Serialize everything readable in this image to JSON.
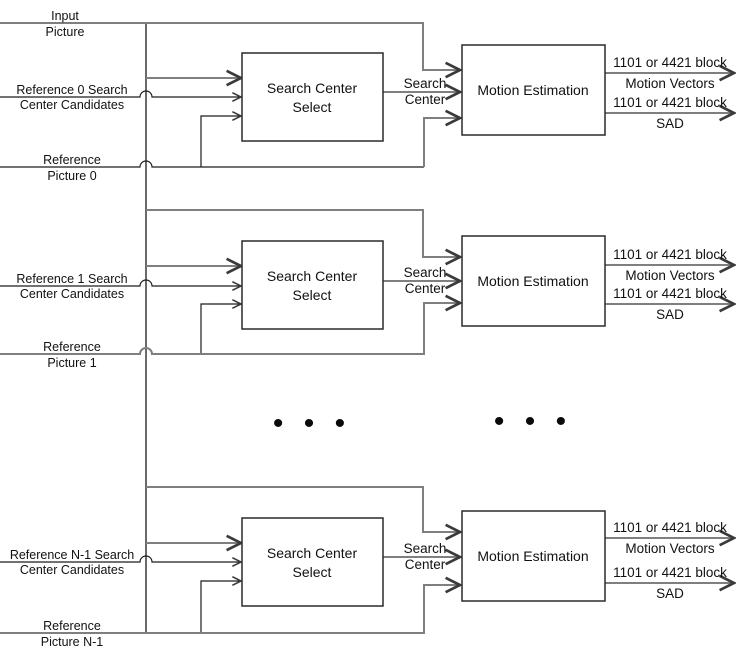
{
  "colors": {
    "line_gray": "#7f7f7f",
    "line_dark": "#1c1c1c",
    "text": "#111111",
    "background": "#ffffff"
  },
  "input_picture": {
    "top": "Input",
    "bottom": "Picture"
  },
  "ellipsis": {
    "glyph": "• • •"
  },
  "rows": [
    {
      "candidates_top": "Reference 0 Search",
      "candidates_bottom": "Center Candidates",
      "ref_top": "Reference",
      "ref_bottom": "Picture 0",
      "scs_line1": "Search Center",
      "scs_line2": "Select",
      "me_label": "Motion Estimation",
      "sc_top": "Search",
      "sc_bottom": "Center",
      "out1_top": "1101 or 4421 block",
      "out1_bottom": "Motion Vectors",
      "out2_top": "1101 or 4421 block",
      "out2_bottom": "SAD"
    },
    {
      "candidates_top": "Reference 1 Search",
      "candidates_bottom": "Center Candidates",
      "ref_top": "Reference",
      "ref_bottom": "Picture 1",
      "scs_line1": "Search Center",
      "scs_line2": "Select",
      "me_label": "Motion Estimation",
      "sc_top": "Search",
      "sc_bottom": "Center",
      "out1_top": "1101 or 4421 block",
      "out1_bottom": "Motion Vectors",
      "out2_top": "1101 or 4421 block",
      "out2_bottom": "SAD"
    },
    {
      "candidates_top": "Reference N-1 Search",
      "candidates_bottom": "Center Candidates",
      "ref_top": "Reference",
      "ref_bottom": "Picture N-1",
      "scs_line1": "Search Center",
      "scs_line2": "Select",
      "me_label": "Motion Estimation",
      "sc_top": "Search",
      "sc_bottom": "Center",
      "out1_top": "1101 or 4421 block",
      "out1_bottom": "Motion Vectors",
      "out2_top": "1101 or 4421 block",
      "out2_bottom": "SAD"
    }
  ]
}
